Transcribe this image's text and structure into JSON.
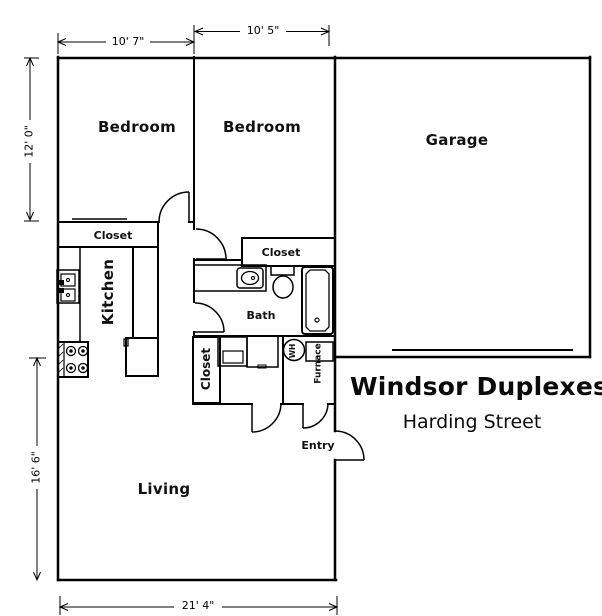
{
  "header": {
    "title": "Windsor Duplexes",
    "subtitle": "Harding Street"
  },
  "rooms": {
    "bedroom_left": "Bedroom",
    "bedroom_right": "Bedroom",
    "garage": "Garage",
    "kitchen": "Kitchen",
    "bath": "Bath",
    "living": "Living",
    "entry": "Entry"
  },
  "closets": {
    "hall": "Closet",
    "bath": "Closet",
    "laundry": "Closet"
  },
  "equipment": {
    "water_heater": "WH",
    "furnace": "Furnace"
  },
  "dimensions": {
    "bedroom_left_width": "10' 7\"",
    "bedroom_right_width": "10' 5\"",
    "bedroom_depth": "12' 0\"",
    "living_depth": "16' 6\"",
    "unit_width": "21' 4\""
  },
  "colors": {
    "line": "#000000",
    "background": "#ffffff"
  }
}
